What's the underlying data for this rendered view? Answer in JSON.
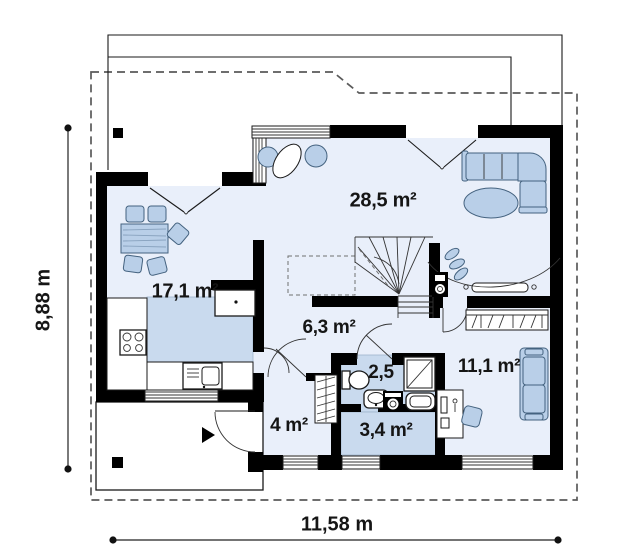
{
  "plan": {
    "rooms": {
      "living": {
        "area": "28,5 m²"
      },
      "kitchen_dining": {
        "area": "17,1 m²"
      },
      "hall": {
        "area": "6,3 m²"
      },
      "bathroom": {
        "area": "2,5"
      },
      "utility": {
        "area": "3,4 m²"
      },
      "bedroom": {
        "area": "11,1 m²"
      },
      "vestibule": {
        "area": "4 m²"
      }
    },
    "dimensions": {
      "height": "8,88 m",
      "width": "11,58 m"
    },
    "colors": {
      "wall": "#000000",
      "room_fill": "#e9effa",
      "shaded_fill": "#c9daee",
      "furniture_fill": "#b9cfe8",
      "furniture_outline": "#44627f",
      "boundary_dash": "#5a5a5a",
      "label_text": "#151515"
    }
  }
}
